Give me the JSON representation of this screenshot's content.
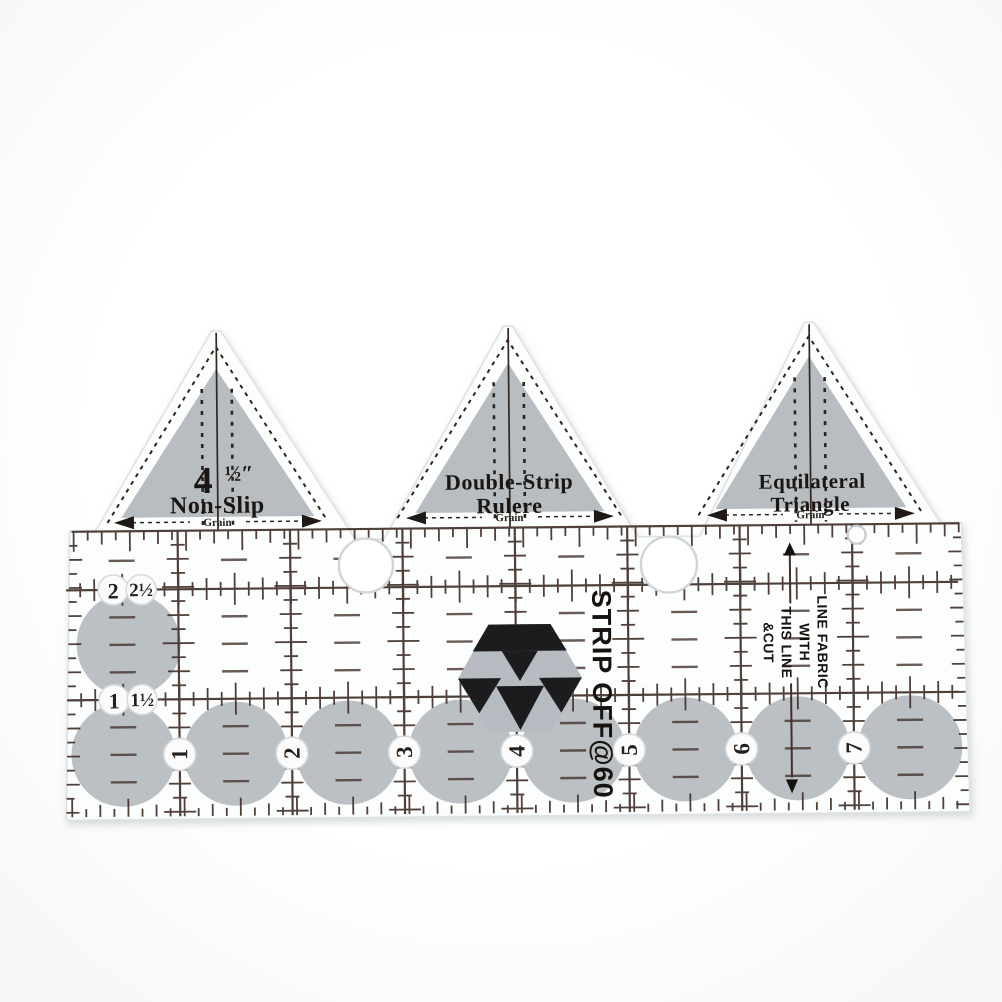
{
  "ruler": {
    "triangles": [
      {
        "size_whole": "4",
        "size_fraction": "½″",
        "name": "Non-Slip",
        "grain_label": "Grain"
      },
      {
        "name_line1": "Double-Strip",
        "name_line2": "Rulere",
        "grain_label": "Grain"
      },
      {
        "name_line1": "Equilateral",
        "name_line2": "Triangle",
        "grain_label": "Grain"
      }
    ],
    "half_inch_labels": [
      "2",
      "2½",
      "1",
      "1½"
    ],
    "inch_numbers": [
      "1",
      "2",
      "3",
      "4",
      "5",
      "6",
      "7"
    ],
    "brand": "STRIP OFF@60",
    "cut_instruction": [
      "LINE FABRIC",
      "WITH",
      "THIS LINE",
      "&CUT"
    ]
  },
  "colors": {
    "print_line": "#42302a",
    "ink_black": "#1b1814",
    "logo_black": "#1c1c1e",
    "soft_gray": "#b5bbbf",
    "body_white": "#fcfdfd"
  }
}
